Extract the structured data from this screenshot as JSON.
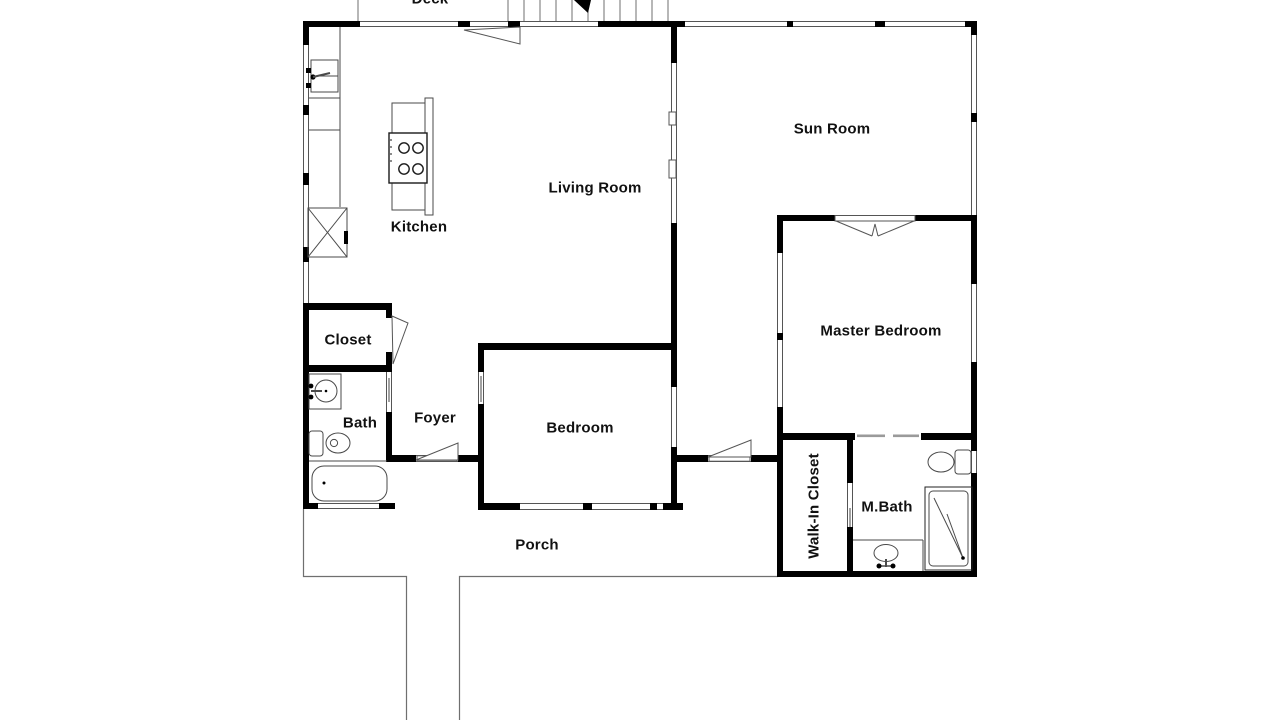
{
  "title": "Single-story house floor plan",
  "colors": {
    "wall": "#000000",
    "thin_line": "#6f6f6f",
    "fixture_line": "#4a4a4a",
    "background": "#ffffff",
    "text": "#111111"
  },
  "rooms": [
    {
      "id": "deck",
      "label": "Deck"
    },
    {
      "id": "living-room",
      "label": "Living Room"
    },
    {
      "id": "sun-room",
      "label": "Sun Room"
    },
    {
      "id": "kitchen",
      "label": "Kitchen"
    },
    {
      "id": "master-bedroom",
      "label": "Master Bedroom"
    },
    {
      "id": "closet",
      "label": "Closet"
    },
    {
      "id": "bath",
      "label": "Bath"
    },
    {
      "id": "foyer",
      "label": "Foyer"
    },
    {
      "id": "bedroom",
      "label": "Bedroom"
    },
    {
      "id": "walk-in-closet",
      "label": "Walk-In Closet"
    },
    {
      "id": "m-bath",
      "label": "M.Bath"
    },
    {
      "id": "porch",
      "label": "Porch"
    }
  ]
}
